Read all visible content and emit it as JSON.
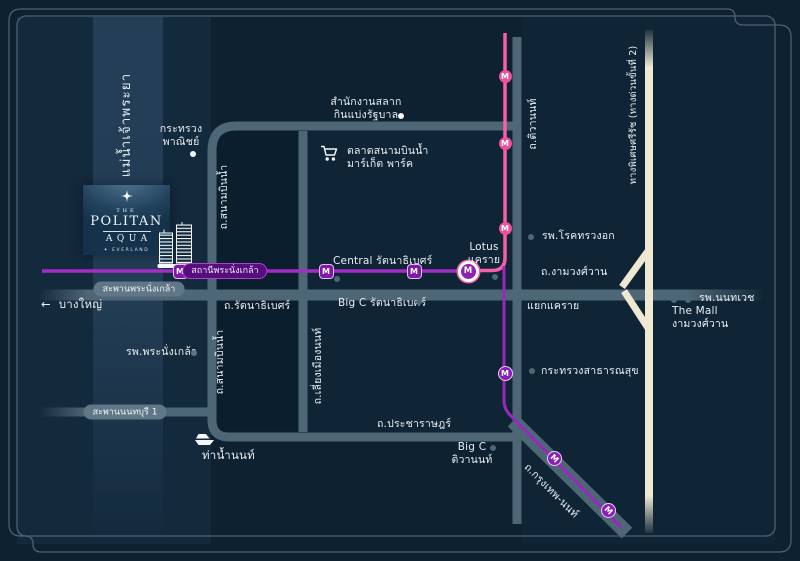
{
  "title": "The Politan Aqua location map",
  "logo": {
    "the": "THE",
    "name": "POLITAN",
    "aqua": "AQUA",
    "by_mark": "✦",
    "by": "EVERLAND"
  },
  "river": {
    "name": "แม่น้ำเจ้าพระยา"
  },
  "mrt": {
    "marker_letter": "M",
    "station_phra_nangklao": "สถานีพระนั่งเกล้า"
  },
  "roads": {
    "sanambinnam_north": "ถ.สนามบินน้ำ",
    "sanambinnam_south": "ถ.สนามบินน้ำ",
    "liang_mueang_non": "ถ.เลี่ยงเมืองนนท์",
    "tiwanon": "ถ.ติวานนท์",
    "rattanathibet": "ถ.รัตนาธิเบศร์",
    "ngamwongwan": "ถ.งามวงศ์วาน",
    "pracharat": "ถ.ประชาราษฎร์",
    "krungthep_non": "ถ.กรุงเทพ-นนท์",
    "expressway": "ทางพิเศษศรีรัช (ทางด่วนขั้นที่ 2)",
    "phra_nangklao_bridge": "สะพานพระนั่งเกล้า",
    "nonthaburi_bridge_1": "สะพานนนทบุรี 1"
  },
  "places": {
    "ministry_commerce_1": "กระทรวง",
    "ministry_commerce_2": "พาณิชย์",
    "lottery_1": "สำนักงานสลาก",
    "lottery_2": "กินแบ่งรัฐบาล",
    "market_1": "ตลาดสนามบินน้ำ",
    "market_2": "มาร์เก็ต พาร์ค",
    "central_rattanathibet": "Central รัตนาธิเบศร์",
    "lotus_1": "Lotus",
    "lotus_2": "แคราย",
    "chest_hospital": "รพ.โรคทรวงอก",
    "khae_rai_intersection": "แยกแคราย",
    "nonthavej_hospital": "รพ.นนทเวช",
    "the_mall_1": "The Mall",
    "the_mall_2": "งามวงศ์วาน",
    "public_health_ministry": "กระทรวงสาธารณสุข",
    "big_c_rattanathibet": "Big C รัตนาธิเบศร์",
    "big_c_tiwanon_1": "Big C",
    "big_c_tiwanon_2": "ติวานนท์",
    "phra_nangklao_hospital": "รพ.พระนั่งเกล้า",
    "nonthaburi_pier": "ท่าน้ำนนท์",
    "bang_yai": "บางใหญ่",
    "bang_yai_arrow": "←"
  },
  "colors": {
    "background": "#0d2130",
    "road": "#4e6777",
    "expressway": "#efe8d2",
    "mrt_pink": "#f75fa8",
    "mrt_purple": "#a32cc4",
    "text": "#e9eff3"
  }
}
